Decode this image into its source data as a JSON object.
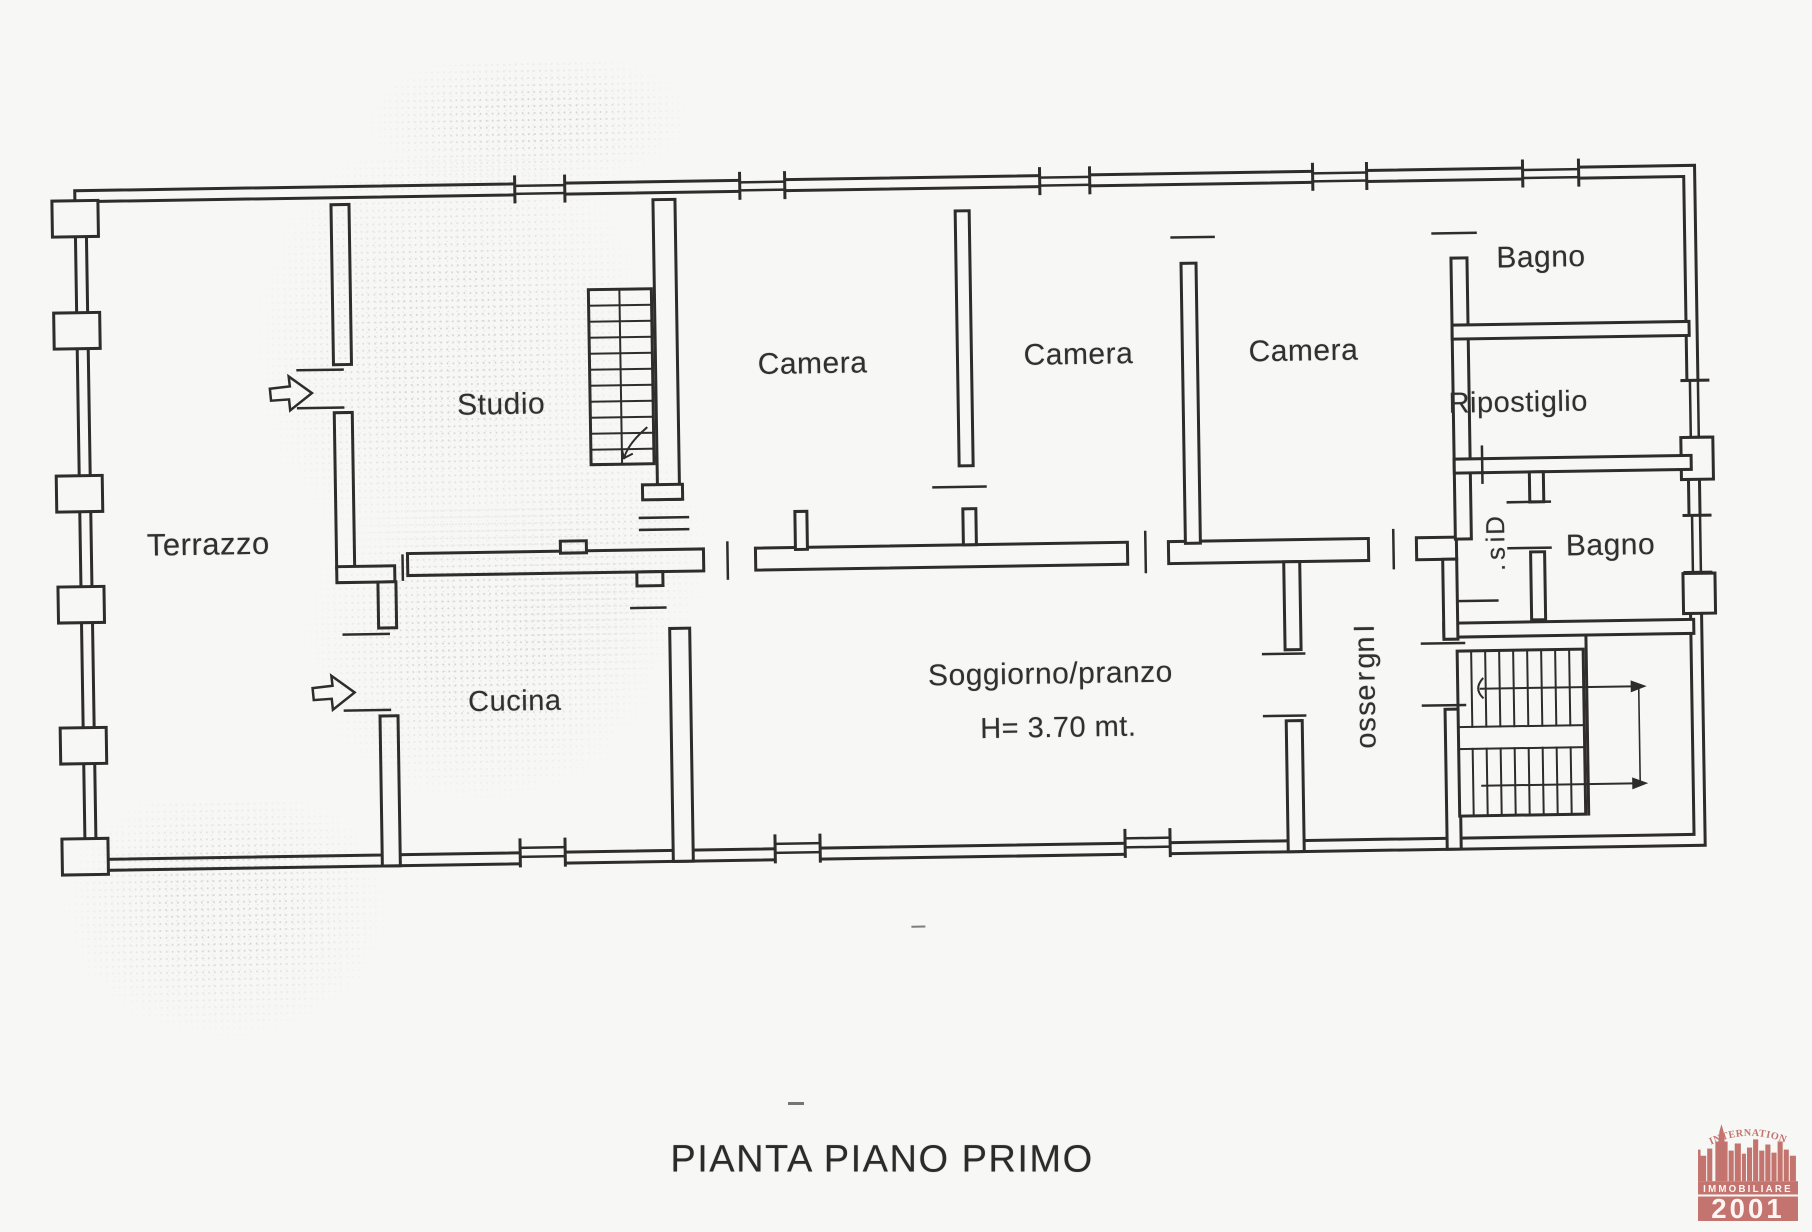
{
  "title": "PIANTA PIANO PRIMO",
  "rooms": {
    "terrazzo": "Terrazzo",
    "studio": "Studio",
    "camera_1": "Camera",
    "camera_2": "Camera",
    "camera_3": "Camera",
    "bagno_top": "Bagno",
    "ripostiglio": "Ripostiglio",
    "dis": "Dis.",
    "bagno_right": "Bagno",
    "cucina": "Cucina",
    "soggiorno": "Soggiorno/pranzo",
    "soggiorno_height": "H= 3.70 mt.",
    "ingresso": "Ingresso"
  },
  "logo": {
    "top_text": "INTERNATIONAL",
    "middle_text": "IMMOBILIARE",
    "year_text": "2001",
    "color": "#c4746e"
  },
  "colors": {
    "ink": "#2e2d2b",
    "paper": "#f7f7f5"
  }
}
